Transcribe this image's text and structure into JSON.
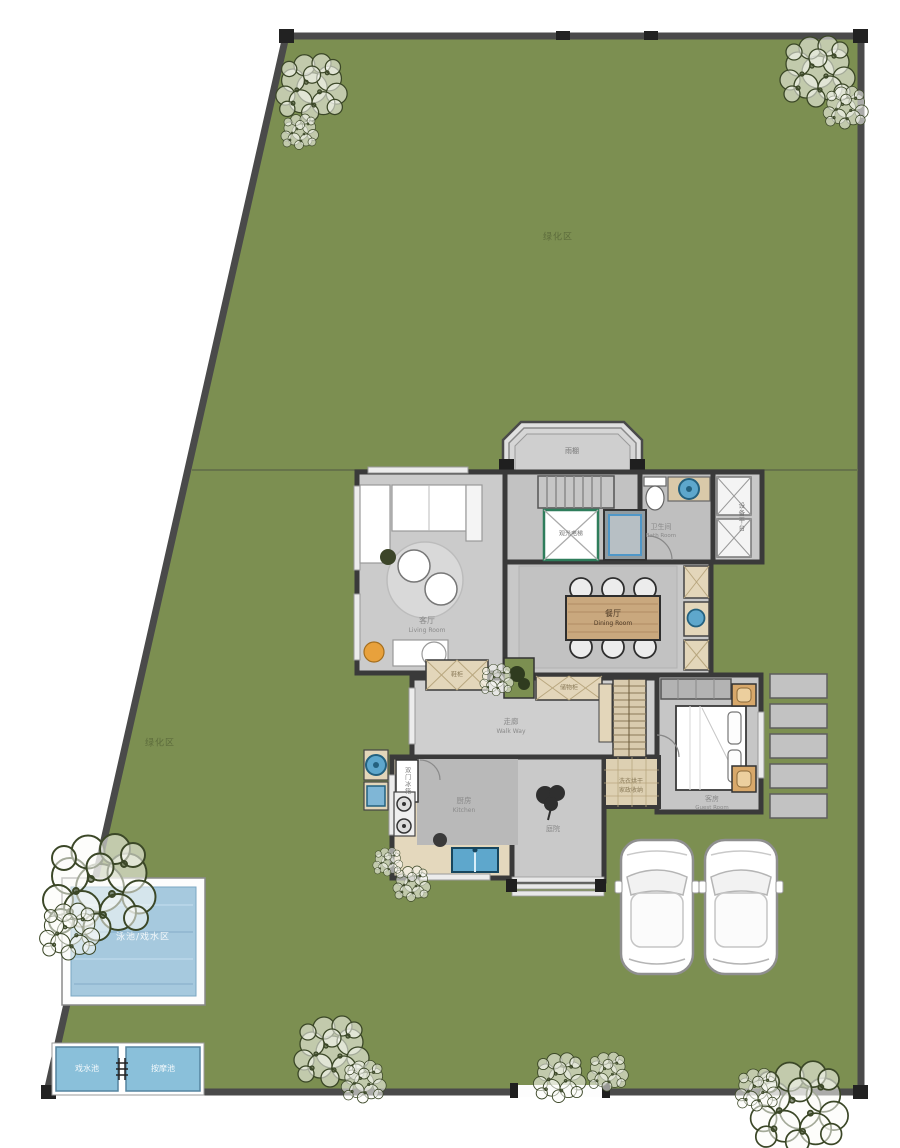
{
  "site": {
    "back_yard_label": "绿化区",
    "side_yard_label": "绿化区"
  },
  "rooms": {
    "porch": {
      "label": "雨棚"
    },
    "living_room": {
      "label_cn": "客厅",
      "label_en": "Living Room"
    },
    "elevator": {
      "label": "观光电梯"
    },
    "bathroom": {
      "label_cn": "卫生间",
      "label_en": "Bath Room"
    },
    "equipment": {
      "label": "设备平台"
    },
    "dining_room": {
      "label_cn": "餐厅",
      "label_en": "Dining Room"
    },
    "bedroom": {
      "label_cn": "客房",
      "label_en": "Guest Room"
    },
    "corridor": {
      "label_cn": "走廊",
      "label_en": "Walk Way"
    },
    "kitchen": {
      "label_cn": "厨房",
      "label_en": "Kitchen"
    },
    "courtyard": {
      "label": "庭院"
    },
    "laundry": {
      "label_line1": "洗衣烘干",
      "label_line2": "家政收纳"
    }
  },
  "fixtures": {
    "fridge_label": "双门冰箱",
    "shoe_cabinet_label": "鞋柜",
    "hall_cabinet_label": "储物柜"
  },
  "outdoor": {
    "pool_label": "泳池/戏水区",
    "tank_left_label": "戏水池",
    "tank_right_label": "按摩池"
  },
  "colors": {
    "lawn": "#7C8F51",
    "wall": "#3A3A3A",
    "pool_water": "#A6C9DE",
    "fixture_blue": "#5EA7CC",
    "wood": "#C9A87E"
  }
}
